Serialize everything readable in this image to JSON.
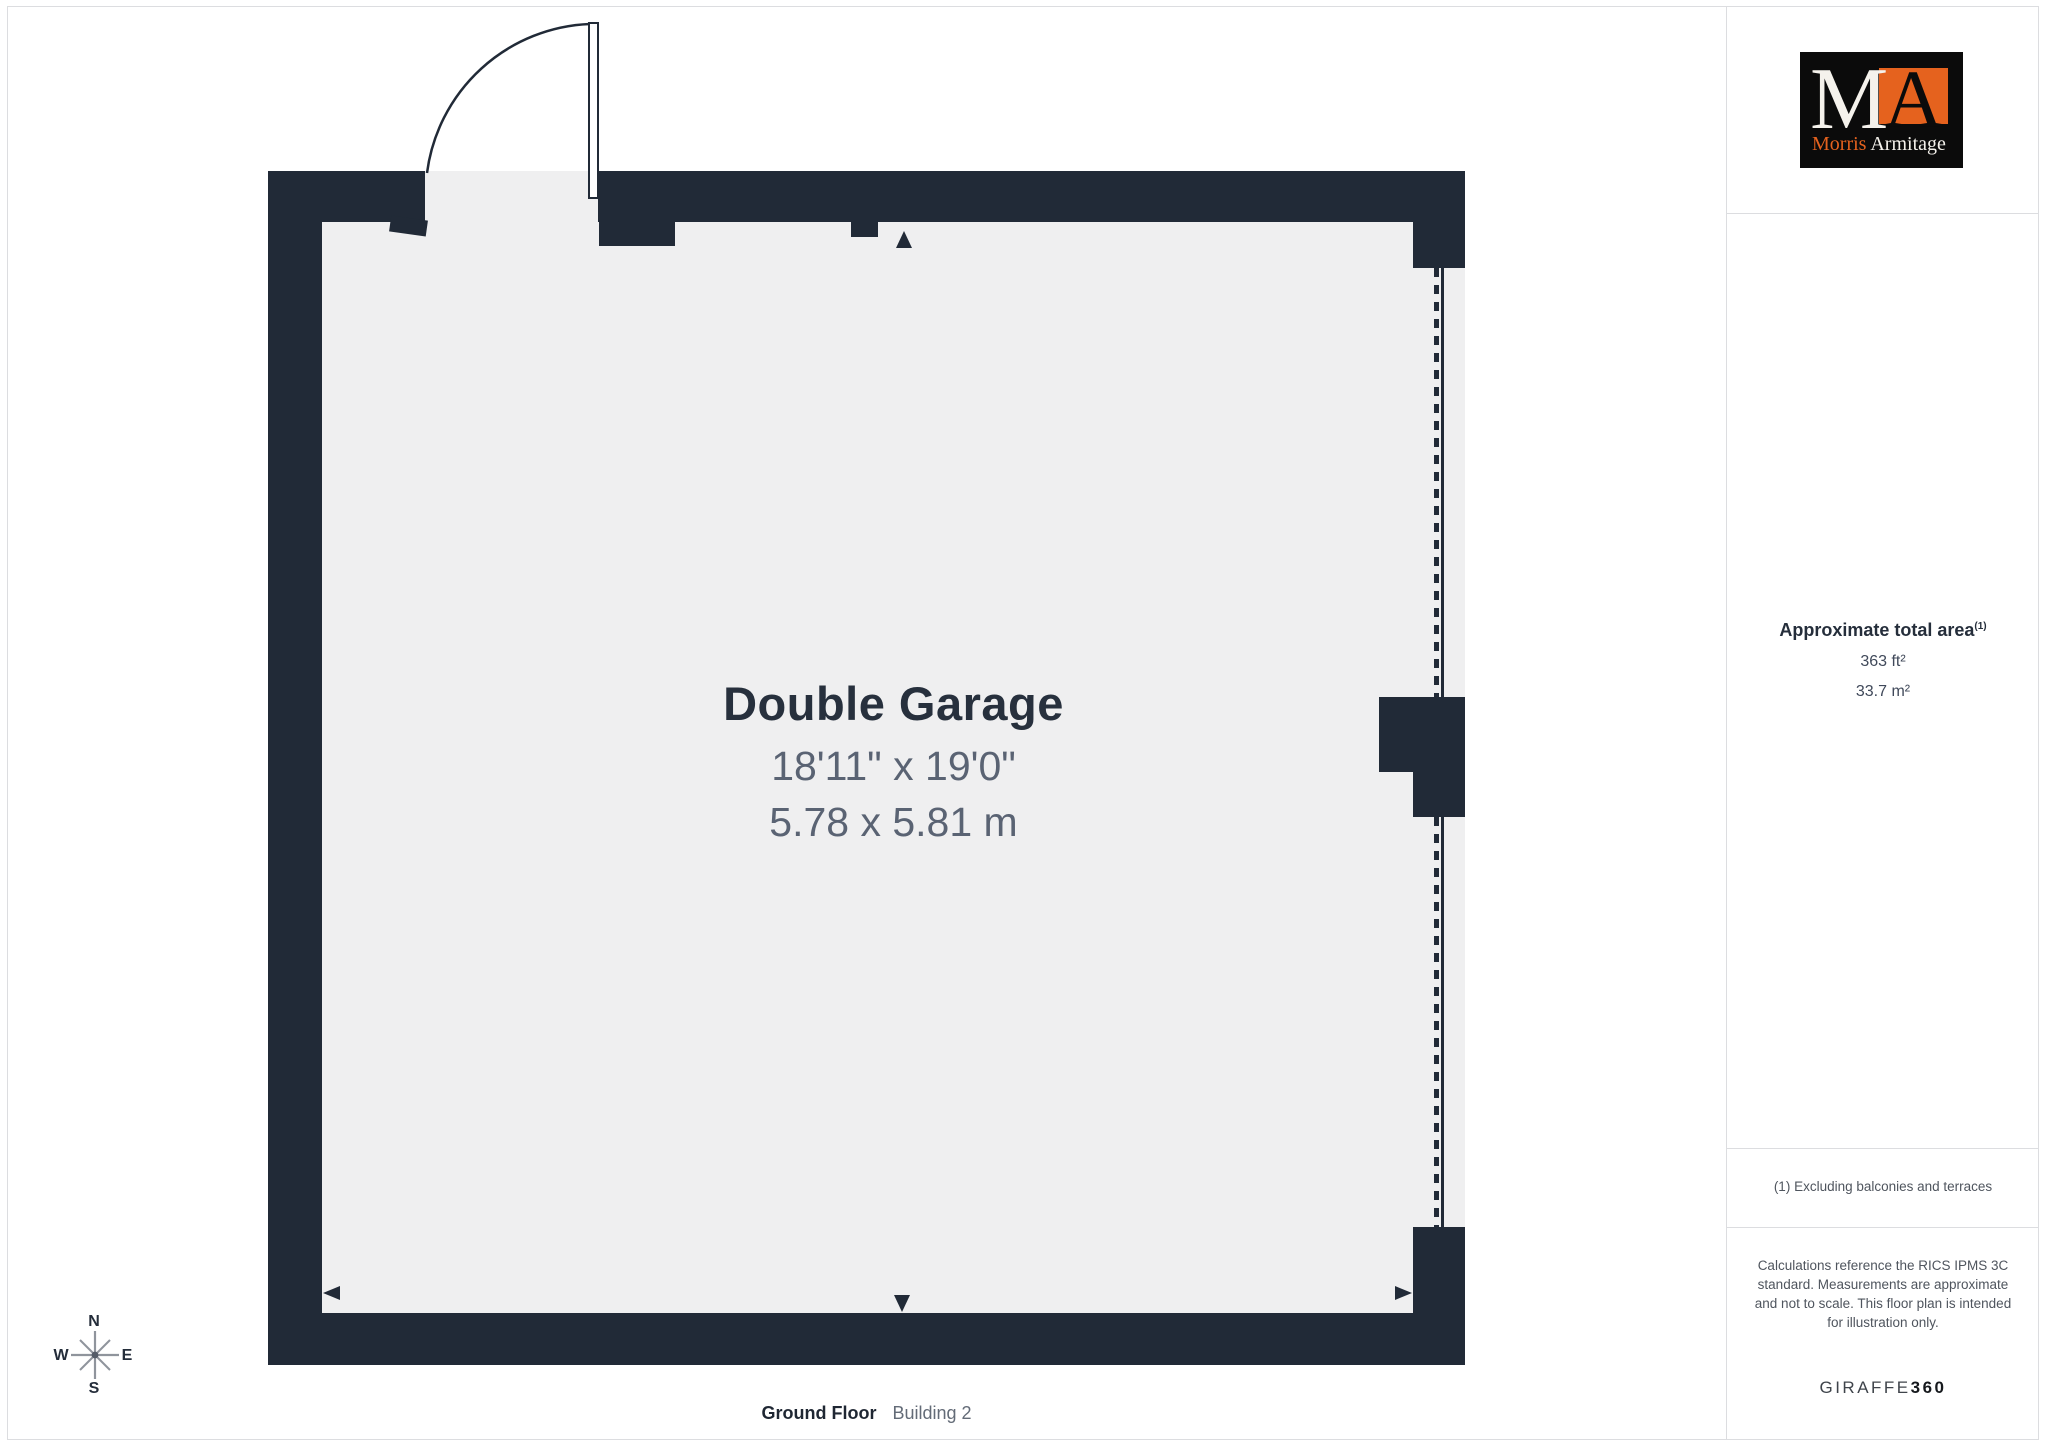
{
  "floorplan": {
    "room_label": "Double Garage",
    "dimensions_imperial": "18'11\" x 19'0\"",
    "dimensions_metric": "5.78 x 5.81 m"
  },
  "compass": {
    "north": "N",
    "south": "S",
    "west": "W",
    "east": "E"
  },
  "footer": {
    "floor_label": "Ground Floor",
    "building_label": "Building 2"
  },
  "sidebar": {
    "logo": {
      "monogram_m": "M",
      "monogram_a": "A",
      "name_first": "Morris",
      "name_last": "Armitage"
    },
    "area": {
      "title": "Approximate total area",
      "title_superscript": "(1)",
      "imperial": "363 ft²",
      "metric": "33.7 m²"
    },
    "footnote": "(1) Excluding balconies and terraces",
    "disclaimer": "Calculations reference the RICS IPMS 3C standard. Measurements are approximate and not to scale. This floor plan is intended for illustration only.",
    "brand": {
      "name_regular": "GIRAFFE",
      "name_bold": "360"
    }
  },
  "colors": {
    "wall": "#212a37",
    "floor": "#efeff0",
    "logo_background": "#0b0b0b",
    "logo_orange": "#e5621e",
    "divider": "#dcdde0"
  }
}
